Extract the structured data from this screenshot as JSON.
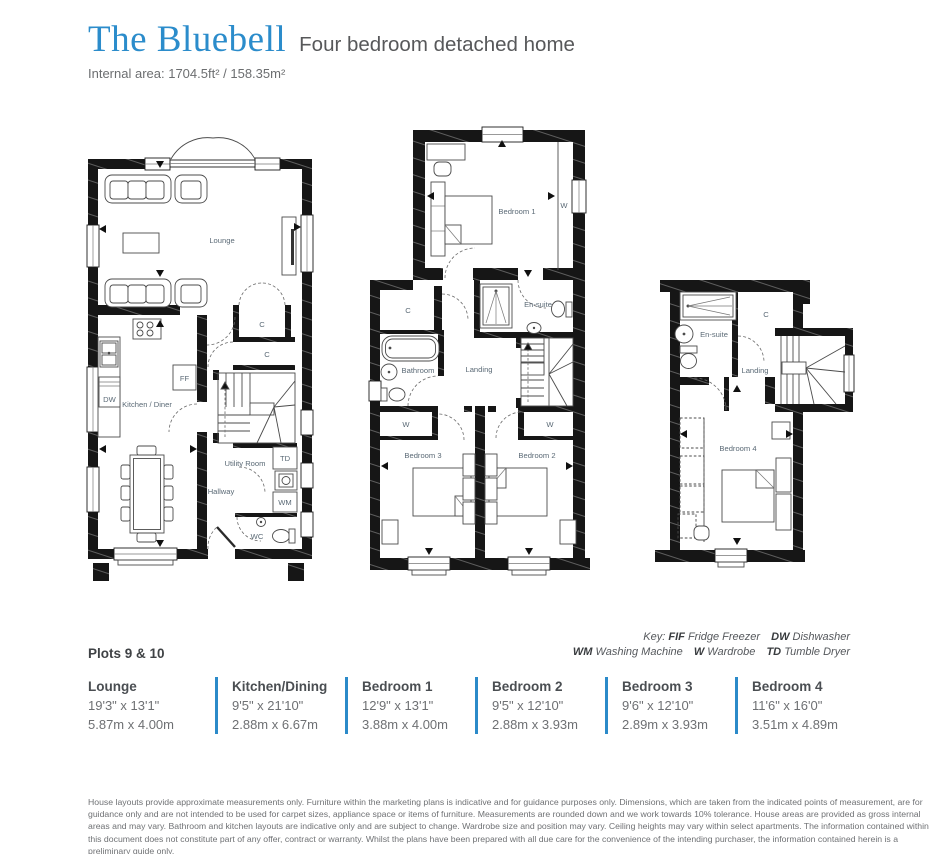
{
  "header": {
    "title": "The Bluebell",
    "subtitle": "Four bedroom detached home",
    "internal_area": "Internal area: 1704.5ft² / 158.35m²"
  },
  "colors": {
    "accent_blue": "#2b8ac9",
    "title_blue": "#2b8ccb",
    "text_dark": "#53565a",
    "text_gray": "#6d6e71",
    "plan_label": "#5b6a76",
    "wall": "#161616"
  },
  "plans": {
    "ground": {
      "lounge": "Lounge",
      "kitchen_diner": "Kitchen / Diner",
      "utility": "Utility Room",
      "hallway": "Hallway",
      "wc": "WC",
      "cupboard_1": "C",
      "cupboard_2": "C",
      "fridge_freezer": "FF",
      "dishwasher": "DW",
      "tumble_dryer": "TD",
      "washing_machine": "WM"
    },
    "first": {
      "bedroom1": "Bedroom 1",
      "bedroom2": "Bedroom 2",
      "bedroom3": "Bedroom 3",
      "bathroom": "Bathroom",
      "ensuite": "En-suite",
      "landing": "Landing",
      "cupboard": "C",
      "wardrobe_1": "W",
      "wardrobe_2": "W",
      "wardrobe_3": "W"
    },
    "second": {
      "bedroom4": "Bedroom 4",
      "ensuite": "En-suite",
      "landing": "Landing",
      "cupboard": "C"
    }
  },
  "plots_label": "Plots 9 & 10",
  "key": {
    "prefix": "Key:",
    "line1": [
      {
        "abbr": "FIF",
        "label": "Fridge Freezer"
      },
      {
        "abbr": "DW",
        "label": "Dishwasher"
      }
    ],
    "line2": [
      {
        "abbr": "WM",
        "label": "Washing Machine"
      },
      {
        "abbr": "W",
        "label": "Wardrobe"
      },
      {
        "abbr": "TD",
        "label": "Tumble Dryer"
      }
    ]
  },
  "rooms": [
    {
      "name": "Lounge",
      "imperial": "19'3\" x 13'1\"",
      "metric": "5.87m x 4.00m"
    },
    {
      "name": "Kitchen/Dining",
      "imperial": "9'5\" x 21'10\"",
      "metric": "2.88m x 6.67m"
    },
    {
      "name": "Bedroom 1",
      "imperial": "12'9\" x 13'1\"",
      "metric": "3.88m x 4.00m"
    },
    {
      "name": "Bedroom 2",
      "imperial": "9'5\" x 12'10\"",
      "metric": "2.88m x 3.93m"
    },
    {
      "name": "Bedroom 3",
      "imperial": "9'6\" x 12'10\"",
      "metric": "2.89m x 3.93m"
    },
    {
      "name": "Bedroom 4",
      "imperial": "11'6\" x 16'0\"",
      "metric": "3.51m x 4.89m"
    }
  ],
  "disclaimer": "House layouts provide approximate measurements only. Furniture within the marketing plans is indicative and for guidance purposes only. Dimensions, which are taken from the indicated points of measurement, are for guidance only and are not intended to be used for carpet sizes, appliance space or items of furniture. Measurements are rounded down and we work towards 10% tolerance. House areas are provided as gross internal areas and may vary. Bathroom and kitchen layouts are indicative only and are subject to change. Wardrobe size and position may vary. Ceiling heights may vary within select apartments. The information contained within this document does not constitute part of any offer, contract or warranty. Whilst the plans have been prepared with all due care for the convenience of the intending purchaser, the information contained herein is a preliminary guide only."
}
